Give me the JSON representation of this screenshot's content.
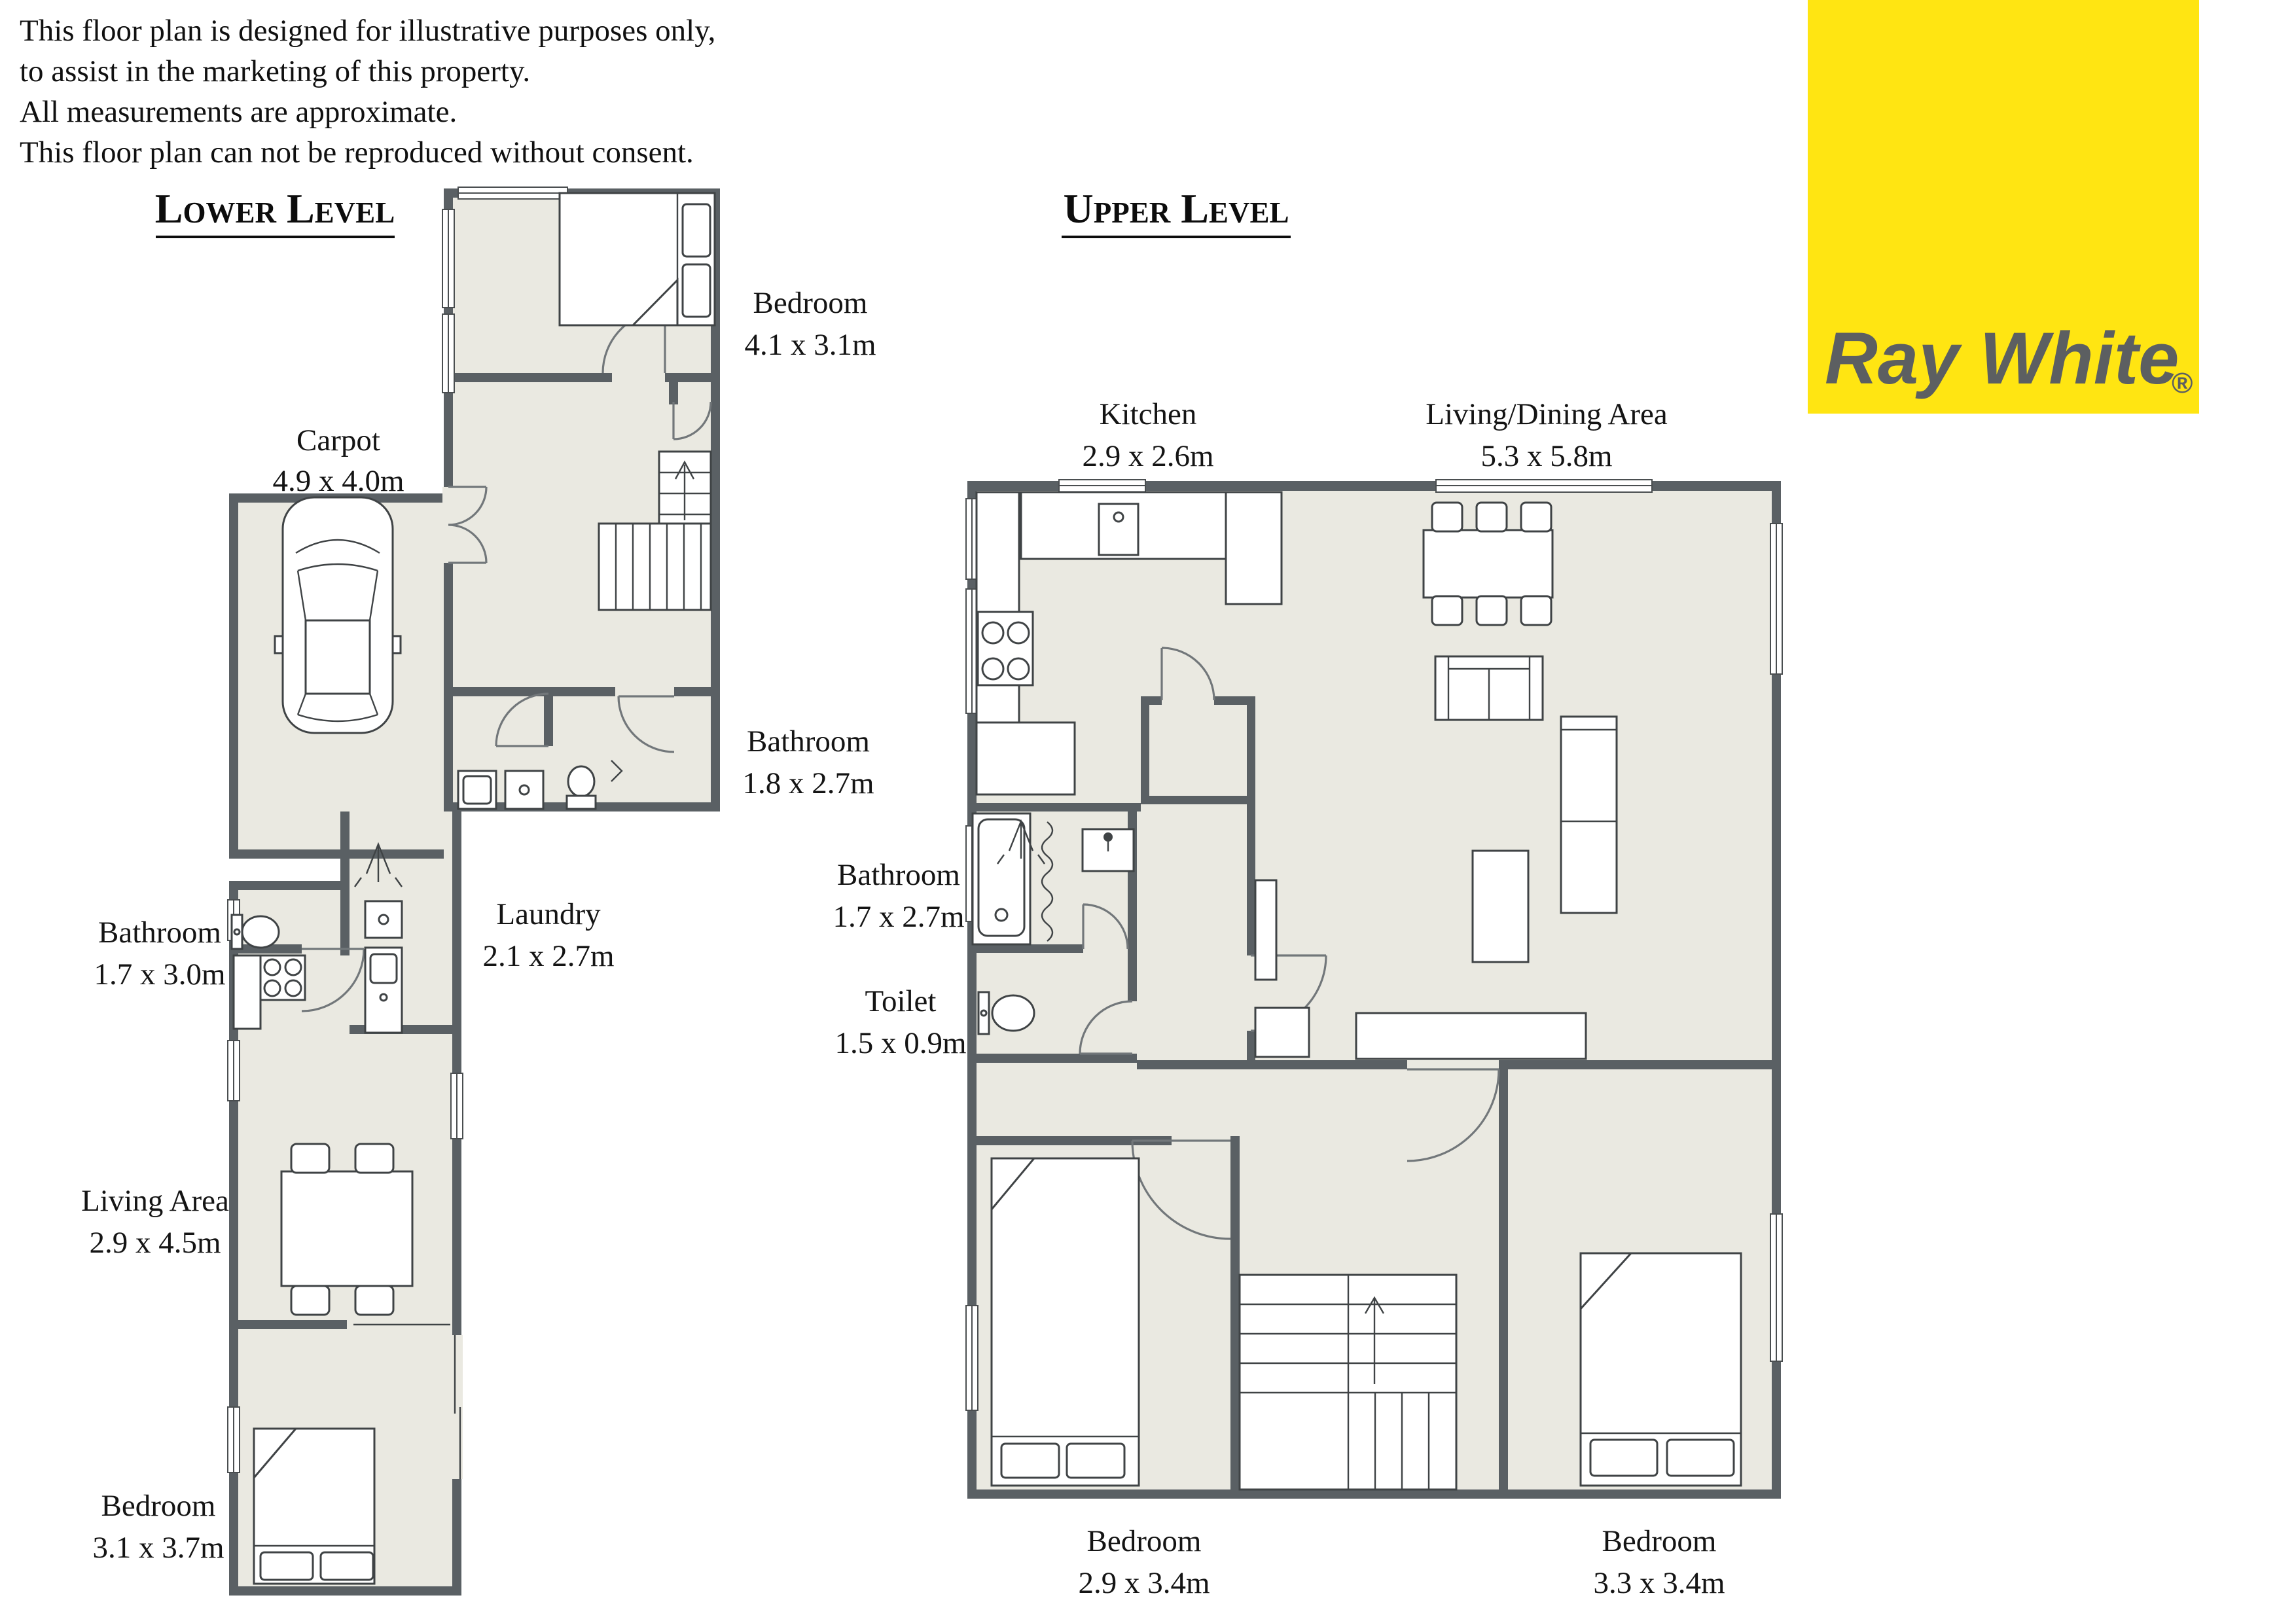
{
  "disclaimer": {
    "line1": "This floor plan is designed for illustrative purposes only,",
    "line2": "to assist in the marketing of this property.",
    "line3": "All measurements are approximate.",
    "line4": "This floor plan can not be reproduced without consent."
  },
  "titles": {
    "lower": "Lower Level",
    "upper": "Upper Level"
  },
  "brand": {
    "name": "Ray White",
    "registered": "®"
  },
  "colors": {
    "brand_bg": "#FFE512",
    "brand_text": "#5C5F61",
    "wall": "#5A6064",
    "floor": "#EAE9E1"
  },
  "rooms": {
    "lower": [
      {
        "name": "Bedroom",
        "dims": "4.1 x 3.1m"
      },
      {
        "name": "Carpot",
        "dims": "4.9 x 4.0m"
      },
      {
        "name": "Bathroom",
        "dims": "1.8 x 2.7m"
      },
      {
        "name": "Laundry",
        "dims": "2.1 x 2.7m"
      },
      {
        "name": "Bathroom",
        "dims": "1.7 x 3.0m"
      },
      {
        "name": "Living Area",
        "dims": "2.9 x 4.5m"
      },
      {
        "name": "Bedroom",
        "dims": "3.1 x 3.7m"
      }
    ],
    "upper": [
      {
        "name": "Kitchen",
        "dims": "2.9 x 2.6m"
      },
      {
        "name": "Living/Dining Area",
        "dims": "5.3 x 5.8m"
      },
      {
        "name": "Bathroom",
        "dims": "1.7 x 2.7m"
      },
      {
        "name": "Toilet",
        "dims": "1.5 x 0.9m"
      },
      {
        "name": "Bedroom",
        "dims": "2.9 x 3.4m"
      },
      {
        "name": "Bedroom",
        "dims": "3.3 x 3.4m"
      }
    ]
  }
}
